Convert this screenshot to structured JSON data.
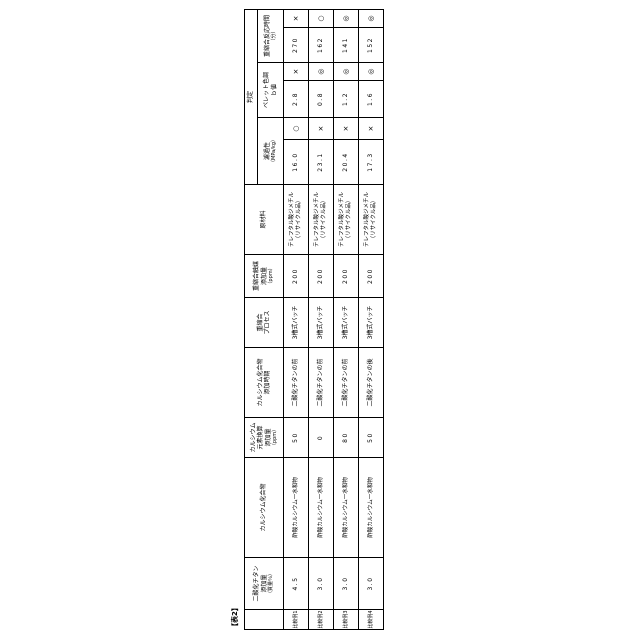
{
  "table_label": "【表2】",
  "headers": {
    "row_label": "",
    "tio2": {
      "l1": "二酸化チタン",
      "l2": "添加量",
      "unit": "（質量％）"
    },
    "ca_compound": {
      "l1": "カルシウム化合物"
    },
    "ca_ppm": {
      "l1": "カルシウム",
      "l2": "元素換算",
      "l3": "添加量",
      "unit": "（ppm）"
    },
    "ca_timing": {
      "l1": "カルシウム化合物",
      "l2": "添加時期"
    },
    "process": {
      "l1": "重縮合",
      "l2": "プロセス"
    },
    "catalyst": {
      "l1": "重縮合触媒",
      "l2": "添加量",
      "unit": "（ppm）"
    },
    "material": {
      "l1": "原材料"
    },
    "judgment": "判定",
    "m_filter": {
      "l1": "濾過性",
      "unit": "（MPa/kg）"
    },
    "m_color": {
      "l1": "ペレット色調",
      "l2": "ｂ値"
    },
    "m_time": {
      "l1": "重縮合反応時間",
      "unit": "（分）"
    }
  },
  "rows": [
    {
      "label": "比較例1",
      "tio2": "4.5",
      "ca_compound": "酢酸カルシウム一水和物",
      "ca_ppm": "50",
      "ca_timing": "二酸化チタンの前",
      "process": "3槽式バッチ",
      "catalyst_ppm": "200",
      "material1": "テレフタル酸ジメチル",
      "material2": "（リサイクル品）",
      "filter_value": "16.0",
      "filter_mark": "○",
      "color_value": "2.8",
      "color_mark": "×",
      "time_value": "270",
      "time_mark": "×"
    },
    {
      "label": "比較例2",
      "tio2": "3.0",
      "ca_compound": "酢酸カルシウム一水和物",
      "ca_ppm": "0",
      "ca_timing": "二酸化チタンの前",
      "process": "3槽式バッチ",
      "catalyst_ppm": "200",
      "material1": "テレフタル酸ジメチル",
      "material2": "（リサイクル品）",
      "filter_value": "23.1",
      "filter_mark": "×",
      "color_value": "0.8",
      "color_mark": "◎",
      "time_value": "162",
      "time_mark": "○"
    },
    {
      "label": "比較例3",
      "tio2": "3.0",
      "ca_compound": "酢酸カルシウム一水和物",
      "ca_ppm": "80",
      "ca_timing": "二酸化チタンの前",
      "process": "3槽式バッチ",
      "catalyst_ppm": "200",
      "material1": "テレフタル酸ジメチル",
      "material2": "（リサイクル品）",
      "filter_value": "20.4",
      "filter_mark": "×",
      "color_value": "1.2",
      "color_mark": "◎",
      "time_value": "141",
      "time_mark": "◎"
    },
    {
      "label": "比較例4",
      "tio2": "3.0",
      "ca_compound": "酢酸カルシウム一水和物",
      "ca_ppm": "50",
      "ca_timing": "二酸化チタンの後",
      "process": "3槽式バッチ",
      "catalyst_ppm": "200",
      "material1": "テレフタル酸ジメチル",
      "material2": "（リサイクル品）",
      "filter_value": "17.3",
      "filter_mark": "×",
      "color_value": "1.6",
      "color_mark": "◎",
      "time_value": "152",
      "time_mark": "◎"
    }
  ]
}
